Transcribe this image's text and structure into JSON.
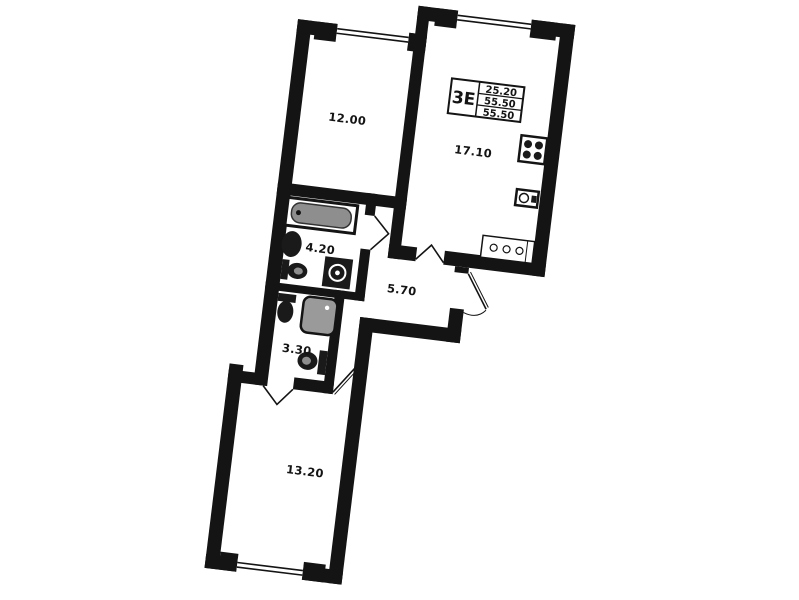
{
  "plan": {
    "type_code": "3Е",
    "area_table": {
      "living_area": "25.20",
      "total_area": "55.50",
      "total_area_reduced": "55.50"
    },
    "rooms": [
      {
        "id": "bedroom-top",
        "area": "12.00"
      },
      {
        "id": "kitchen-living",
        "area": "17.10"
      },
      {
        "id": "bathroom",
        "area": "4.20"
      },
      {
        "id": "hallway",
        "area": "5.70"
      },
      {
        "id": "wc-shower",
        "area": "3.30"
      },
      {
        "id": "bedroom-bottom",
        "area": "13.20"
      }
    ],
    "colors": {
      "wall": "#141414",
      "fixture_gray": "#8e8e8e",
      "background": "#ffffff"
    }
  }
}
